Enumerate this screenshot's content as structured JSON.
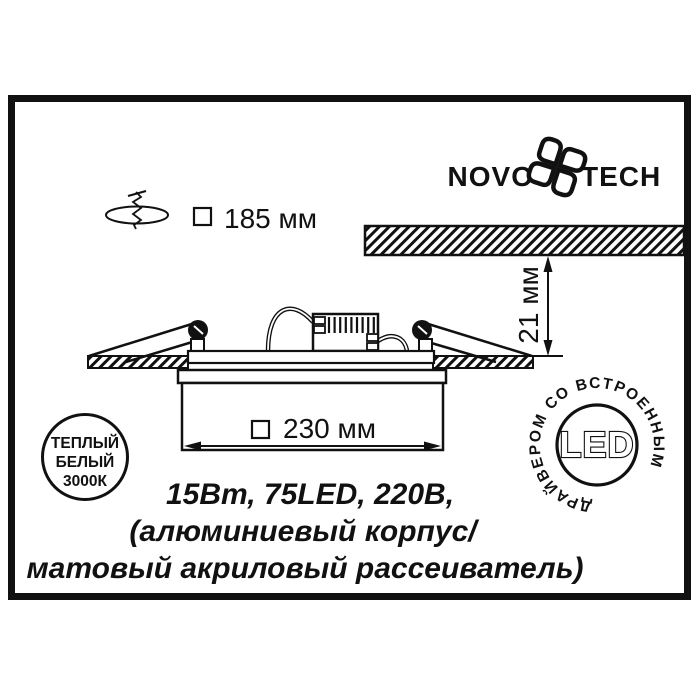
{
  "brand": {
    "wordmark_left": "NOVO",
    "wordmark_right": "TECH"
  },
  "dimensions": {
    "cutout": "185 мм",
    "visible_width": "230 мм",
    "depth": "21 мм"
  },
  "specs": {
    "line1": "15Вт, 75LED, 220В,",
    "line2": "(алюминиевый корпус/",
    "line3": "матовый акриловый рассеиватель)"
  },
  "badge_warm_white": {
    "line1": "ТЕПЛЫЙ",
    "line2": "БЕЛЫЙ",
    "line3": "3000К"
  },
  "badge_led": {
    "center": "LED",
    "ring": "ДРАЙВЕРОМ СО ВСТРОЕННЫМ"
  },
  "colors": {
    "ink": "#111111",
    "background": "#ffffff"
  }
}
